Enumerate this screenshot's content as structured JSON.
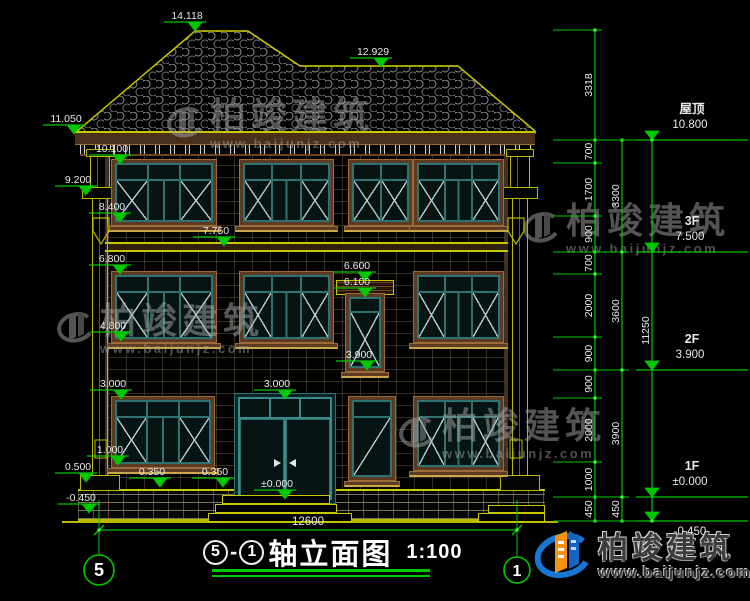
{
  "title": {
    "axis_start_bubble": "5",
    "separator": "-",
    "axis_end_bubble": "1",
    "name": "轴立面图",
    "scale": "1:100"
  },
  "watermark": {
    "brand": "柏竣建筑",
    "site": "www.baijunjz.com",
    "positions": [
      {
        "x": 160,
        "y": 98
      },
      {
        "x": 516,
        "y": 203
      },
      {
        "x": 50,
        "y": 303
      },
      {
        "x": 392,
        "y": 408
      }
    ]
  },
  "logo": {
    "brand": "柏竣建筑",
    "site": "www.baijunjz.com"
  },
  "annotations": {
    "left_levels": [
      {
        "text": "14.118",
        "x": 187,
        "y": 31
      },
      {
        "text": "12.929",
        "x": 373,
        "y": 67
      },
      {
        "text": "11.050",
        "x": 66,
        "y": 134
      },
      {
        "text": "10.100",
        "x": 112,
        "y": 164
      },
      {
        "text": "9.200",
        "x": 78,
        "y": 195
      },
      {
        "text": "8.400",
        "x": 112,
        "y": 222
      },
      {
        "text": "7.750",
        "x": 216,
        "y": 246
      },
      {
        "text": "6.800",
        "x": 112,
        "y": 274
      },
      {
        "text": "6.600",
        "x": 357,
        "y": 281
      },
      {
        "text": "6.100",
        "x": 357,
        "y": 297
      },
      {
        "text": "4.800",
        "x": 113,
        "y": 341
      },
      {
        "text": "3.900",
        "x": 359,
        "y": 370
      },
      {
        "text": "3.000",
        "x": 113,
        "y": 399
      },
      {
        "text": "3.000",
        "x": 277,
        "y": 399
      },
      {
        "text": "1.000",
        "x": 110,
        "y": 465
      },
      {
        "text": "0.500",
        "x": 78,
        "y": 482
      },
      {
        "text": "0.350",
        "x": 152,
        "y": 487
      },
      {
        "text": "0.350",
        "x": 215,
        "y": 487
      },
      {
        "text": "±0.000",
        "x": 277,
        "y": 499
      },
      {
        "text": "-0.450",
        "x": 81,
        "y": 513
      }
    ],
    "right_levels": [
      {
        "label": "屋顶",
        "value": "10.800",
        "y": 140,
        "below": false
      },
      {
        "label": "3F",
        "value": "7.500",
        "y": 252,
        "below": false
      },
      {
        "label": "2F",
        "value": "3.900",
        "y": 370,
        "below": false
      },
      {
        "label": "1F",
        "value": "±0.000",
        "y": 497,
        "below": false
      },
      {
        "label": "",
        "value": "-0.450",
        "y": 521,
        "below": true
      }
    ],
    "chains": [
      {
        "x": 595,
        "boundaries": [
          30,
          140,
          163,
          216,
          252,
          274,
          337,
          370,
          398,
          462,
          497,
          521
        ],
        "labels": [
          "3318",
          "700",
          "1700",
          "900",
          "700",
          "2000",
          "900",
          "900",
          "2000",
          "1000",
          "450"
        ]
      },
      {
        "x": 622,
        "boundaries": [
          140,
          252,
          370,
          497,
          521
        ],
        "labels": [
          "3300",
          "3600",
          "3900",
          "450"
        ]
      },
      {
        "x": 652,
        "boundaries": [
          140,
          521
        ],
        "labels": [
          "11250"
        ]
      }
    ],
    "bottom_dim": {
      "text": "12600",
      "y": 530,
      "x1": 99,
      "x2": 517
    },
    "axis_bubbles": [
      {
        "text": "5",
        "cx": 99,
        "cy": 570,
        "r": 15
      },
      {
        "text": "1",
        "cx": 517,
        "cy": 570,
        "r": 13
      }
    ]
  },
  "windows": [
    {
      "x": 115,
      "y": 163,
      "w": 98,
      "h": 59,
      "style": "t3"
    },
    {
      "x": 243,
      "y": 163,
      "w": 87,
      "h": 59,
      "style": "t3"
    },
    {
      "x": 352,
      "y": 163,
      "w": 57,
      "h": 59,
      "style": "t2"
    },
    {
      "x": 417,
      "y": 163,
      "w": 83,
      "h": 59,
      "style": "t3"
    },
    {
      "x": 115,
      "y": 275,
      "w": 98,
      "h": 64,
      "style": "t3"
    },
    {
      "x": 243,
      "y": 275,
      "w": 87,
      "h": 64,
      "style": "t3"
    },
    {
      "x": 349,
      "y": 297,
      "w": 32,
      "h": 71,
      "style": "tall1"
    },
    {
      "x": 417,
      "y": 275,
      "w": 83,
      "h": 64,
      "style": "t3"
    },
    {
      "x": 115,
      "y": 400,
      "w": 96,
      "h": 64,
      "style": "t3"
    },
    {
      "x": 352,
      "y": 400,
      "w": 40,
      "h": 77,
      "style": "slim"
    },
    {
      "x": 417,
      "y": 400,
      "w": 83,
      "h": 67,
      "style": "t3"
    },
    {
      "x": 238,
      "y": 397,
      "w": 94,
      "h": 103,
      "style": "door"
    }
  ],
  "colors": {
    "dim_green": "#00c800",
    "node_green": "#39ff39",
    "dim_text": "#e8e8e8",
    "roof_yellow": "#c8c800",
    "trim_brown": "#5d3a22",
    "frame_teal": "#2e7272",
    "watermark_gray": "#a8a8a8",
    "logo_blue": "#1976d2",
    "logo_orange": "#f59211"
  }
}
